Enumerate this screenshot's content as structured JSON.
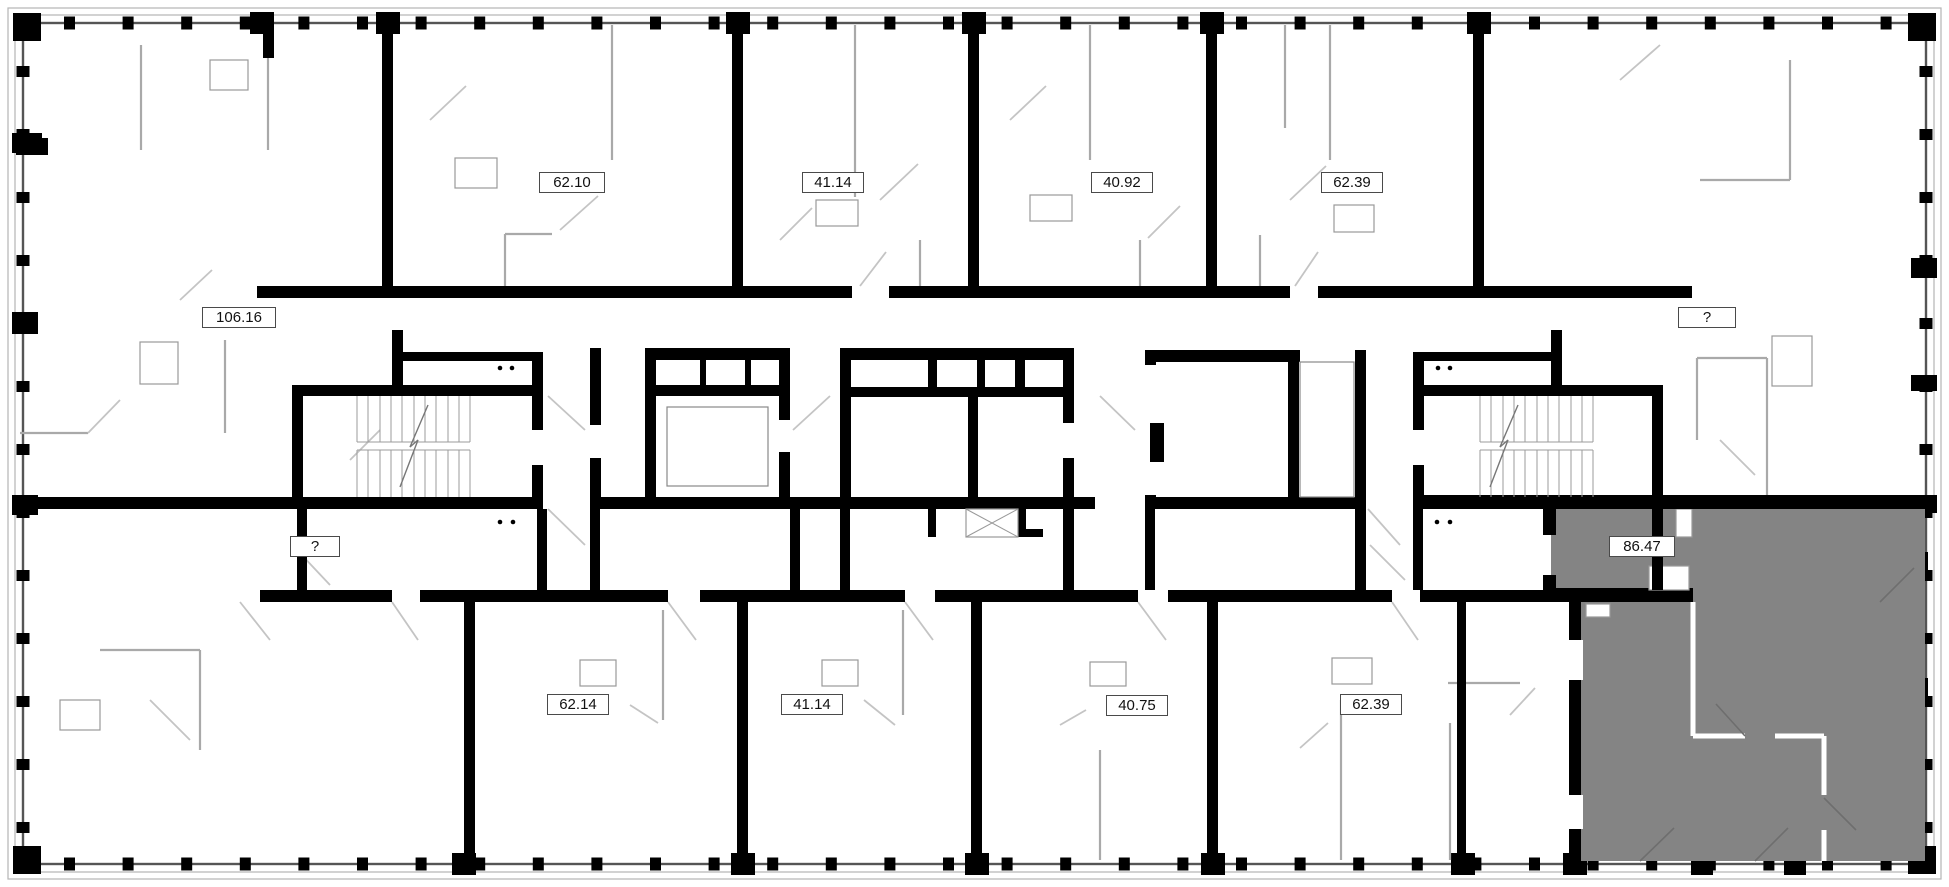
{
  "floorplan": {
    "background_color": "#ffffff",
    "wall_color": "#000000",
    "partition_color": "#a9a9a9",
    "door_swing_color": "#c4c4c4",
    "highlight_fill_color": "#848484",
    "label_border_color": "#4a4a4a",
    "highlighted_unit_area": "86.47"
  },
  "labels": [
    {
      "row": "top",
      "text": "62.10"
    },
    {
      "row": "top",
      "text": "41.14"
    },
    {
      "row": "top",
      "text": "40.92"
    },
    {
      "row": "top",
      "text": "62.39"
    },
    {
      "row": "middle-left",
      "text": "106.16"
    },
    {
      "row": "middle-right",
      "text": "?"
    },
    {
      "row": "bottom-left",
      "text": "?"
    },
    {
      "row": "highlighted",
      "text": "86.47"
    },
    {
      "row": "bottom",
      "text": "62.14"
    },
    {
      "row": "bottom",
      "text": "41.14"
    },
    {
      "row": "bottom",
      "text": "40.75"
    },
    {
      "row": "bottom",
      "text": "62.39"
    }
  ]
}
